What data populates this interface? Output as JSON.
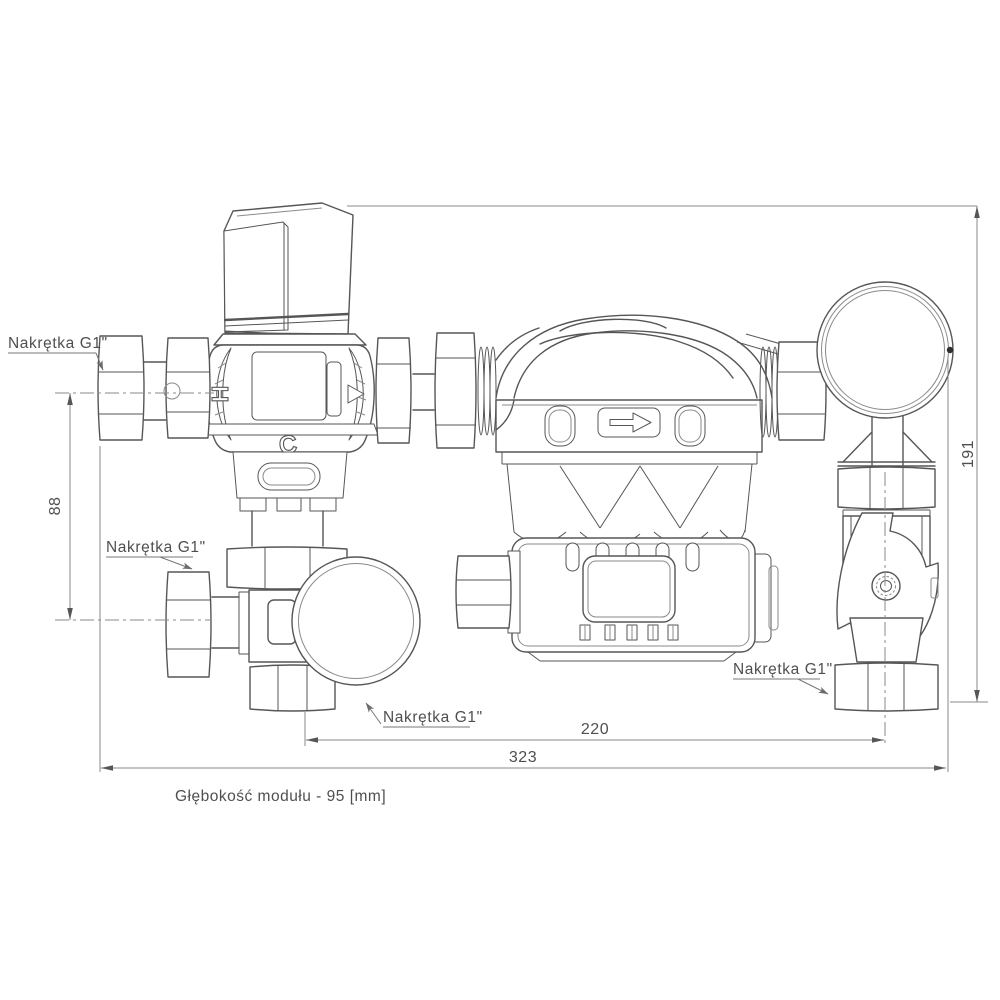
{
  "drawing": {
    "type": "technical-drawing-pump-group",
    "note": "Głębokość modułu - 95 [mm]",
    "nut_labels": {
      "top_left": "Nakrętka G1\"",
      "mid_left": "Nakrętka G1\"",
      "bottom_center": "Nakrętka G1\"",
      "bottom_right": "Nakrętka G1\""
    },
    "dimensions": {
      "left_height_mm": "88",
      "right_height_mm": "191",
      "bottom_inner_width_mm": "220",
      "bottom_total_width_mm": "323"
    },
    "valve_markings": {
      "hot": "H",
      "cold": "C"
    },
    "icons": {
      "flow_direction": "right-arrow-icon"
    },
    "colors": {
      "line": "#565656",
      "thin_line": "#8a8a8a",
      "text": "#4f4f4f",
      "background": "#ffffff"
    }
  }
}
